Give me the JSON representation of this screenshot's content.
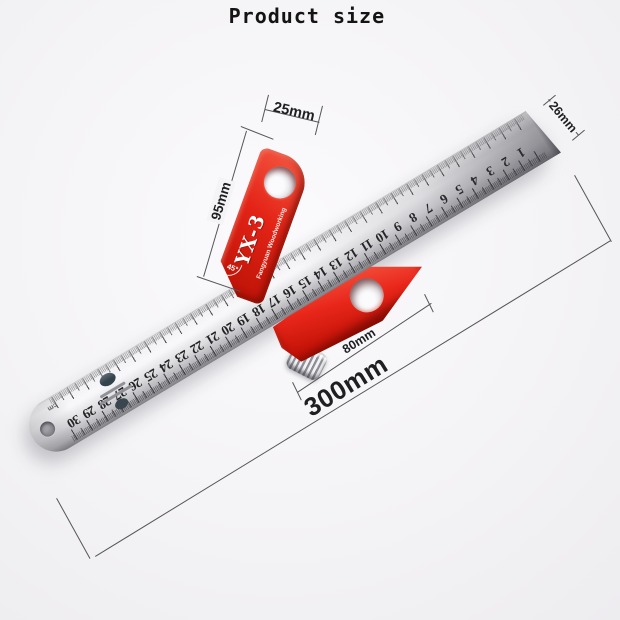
{
  "title": "Product size",
  "annotations": {
    "d25": "25mm",
    "d26": "26mm",
    "d95": "95mm",
    "d80": "80mm",
    "d300": "300mm"
  },
  "tool": {
    "model": "YX-3",
    "brand": "Fangyuan Woodworking",
    "angle": "45°"
  },
  "ruler": {
    "unit": "cm",
    "numbers": [
      "1",
      "2",
      "3",
      "4",
      "5",
      "6",
      "7",
      "8",
      "9",
      "10",
      "11",
      "12",
      "13",
      "14",
      "15",
      "16",
      "17",
      "18",
      "19",
      "20",
      "21",
      "22",
      "23",
      "24",
      "25",
      "26",
      "27",
      "28",
      "29",
      "30"
    ]
  },
  "colors": {
    "background": "#f4f3f5",
    "accent-red": "#e32417",
    "steel": "#d9d9dc",
    "dim-line": "#55555a",
    "screw-blue": "#4a6bd4"
  }
}
